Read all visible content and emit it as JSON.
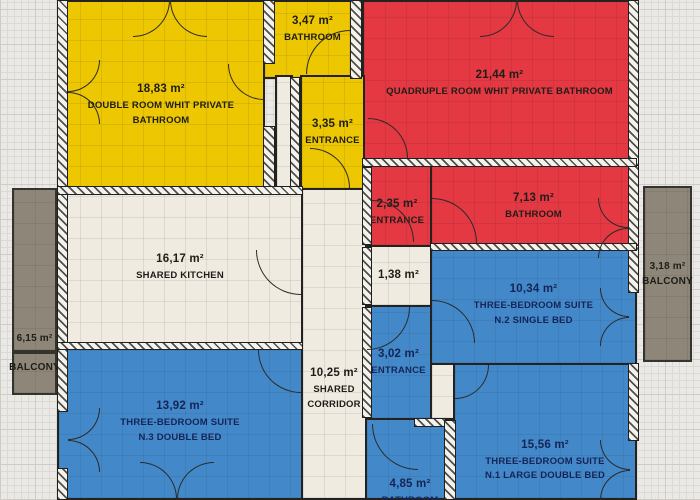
{
  "plan": {
    "type": "apartment-floor-plan",
    "colors": {
      "yellow_room": "#ecc702",
      "red_room": "#e43843",
      "blue_room": "#4389ca",
      "shared_area": "#f0ebe1",
      "balcony_gray": "#8e8779",
      "wall": "#23221f",
      "paper_grid": "#dcdad5"
    },
    "rooms": [
      {
        "id": "double-room",
        "area": "18,83 m²",
        "name": "DOUBLE ROOM WHIT PRIVATE BATHROOM"
      },
      {
        "id": "bathroom-top",
        "area": "3,47 m²",
        "name": "BATHROOM"
      },
      {
        "id": "quadruple-room",
        "area": "21,44 m²",
        "name": "QUADRUPLE ROOM WHIT PRIVATE BATHROOM"
      },
      {
        "id": "entrance-yellow",
        "area": "3,35 m²",
        "name": "ENTRANCE"
      },
      {
        "id": "entrance-red",
        "area": "2,35 m²",
        "name": "ENTRANCE"
      },
      {
        "id": "bathroom-red",
        "area": "7,13 m²",
        "name": "BATHROOM"
      },
      {
        "id": "shared-kitchen",
        "area": "16,17 m²",
        "name": "SHARED KITCHEN"
      },
      {
        "id": "closet",
        "area": "1,38 m²"
      },
      {
        "id": "suite-n2",
        "area": "10,34 m²",
        "name": "THREE-BEDROOM SUITE",
        "line2": "N.2 SINGLE BED"
      },
      {
        "id": "balcony-right",
        "area": "3,18 m²",
        "name": "BALCONY"
      },
      {
        "id": "balcony-left",
        "area": "6,15 m²",
        "name": "BALCONY"
      },
      {
        "id": "entrance-blue",
        "area": "3,02 m²",
        "name": "ENTRANCE"
      },
      {
        "id": "shared-corridor",
        "area": "10,25 m²",
        "name": "SHARED",
        "line2": "CORRIDOR"
      },
      {
        "id": "suite-n3",
        "area": "13,92 m²",
        "name": "THREE-BEDROOM SUITE",
        "line2": "N.3 DOUBLE BED"
      },
      {
        "id": "suite-n1",
        "area": "15,56 m²",
        "name": "THREE-BEDROOM SUITE",
        "line2": "N.1 LARGE DOUBLE BED"
      },
      {
        "id": "bathroom-blue",
        "area": "4,85 m²",
        "name": "BATHROOM"
      }
    ]
  }
}
